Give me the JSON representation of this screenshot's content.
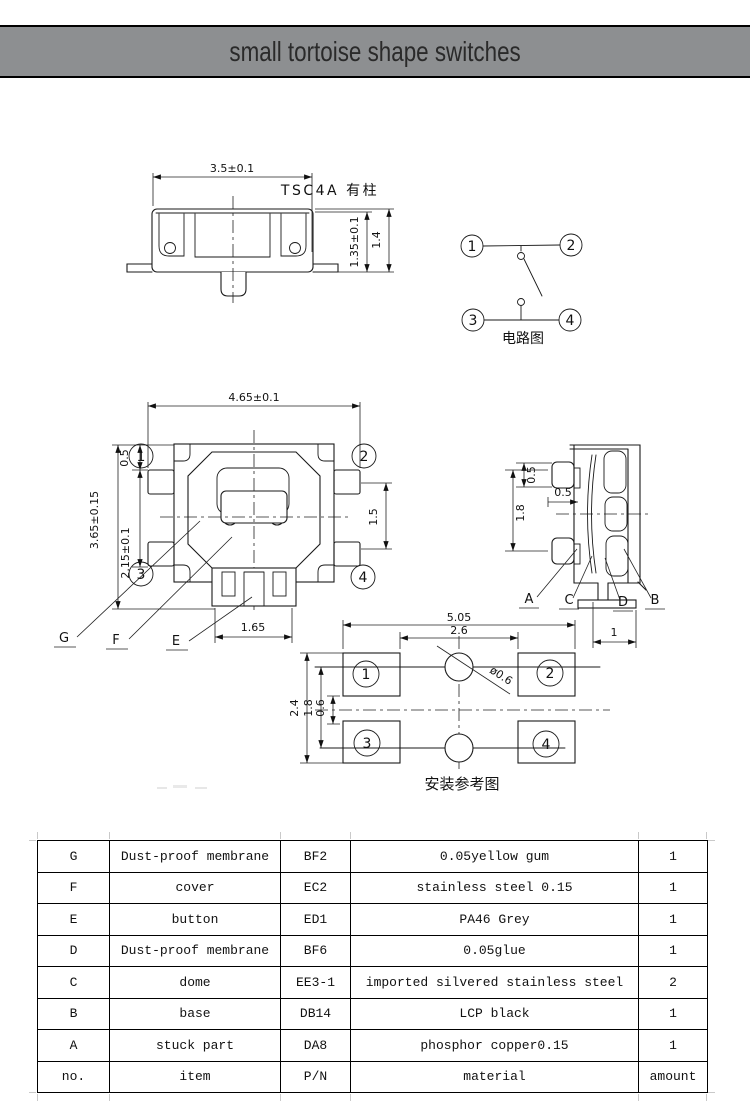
{
  "header": {
    "title": "small tortoise shape switches"
  },
  "side_view": {
    "model_label": "TSC4A 有柱",
    "dim_width": "3.5±0.1",
    "dim_height_inner": "1.35±0.1",
    "dim_height_total": "1.4"
  },
  "circuit": {
    "caption": "电路图",
    "terminals": [
      "1",
      "2",
      "3",
      "4"
    ]
  },
  "top_view": {
    "dim_width": "4.65±0.1",
    "dim_height": "3.65±0.15",
    "dim_offset": "0.5",
    "dim_pitch": "2.15±0.1",
    "dim_button": "1.5",
    "dim_stem": "1.65",
    "terminals": [
      "1",
      "2",
      "3",
      "4"
    ],
    "labels": {
      "g": "G",
      "f": "F",
      "e": "E"
    }
  },
  "right_view": {
    "dim_tab": "0.5",
    "dim_step": "0.5",
    "dim_span": "1.8",
    "dim_foot": "1",
    "labels": {
      "a": "A",
      "c": "C",
      "d": "D",
      "b": "B"
    }
  },
  "mounting": {
    "caption": "安装参考图",
    "dim_outer_width": "5.05",
    "dim_inner_width": "2.6",
    "dim_outer_height": "2.4",
    "dim_hole_pitch": "1.8",
    "dim_gap": "0.6",
    "dim_hole": "ø0.6",
    "terminals": [
      "1",
      "2",
      "3",
      "4"
    ]
  },
  "table": {
    "rows": [
      [
        "G",
        "Dust-proof membrane",
        "BF2",
        "0.05yellow gum",
        "1"
      ],
      [
        "F",
        "cover",
        "EC2",
        "stainless steel 0.15",
        "1"
      ],
      [
        "E",
        "button",
        "ED1",
        "PA46 Grey",
        "1"
      ],
      [
        "D",
        "Dust-proof membrane",
        "BF6",
        "0.05glue",
        "1"
      ],
      [
        "C",
        "dome",
        "EE3-1",
        "imported silvered stainless steel",
        "2"
      ],
      [
        "B",
        "base",
        "DB14",
        "LCP black",
        "1"
      ],
      [
        "A",
        "stuck part",
        "DA8",
        "phosphor copper0.15",
        "1"
      ],
      [
        "no.",
        "item",
        "P/N",
        "material",
        "amount"
      ]
    ]
  },
  "colors": {
    "header_bg": "#8d8f91",
    "rule": "#000000",
    "ink": "#1a1a1a",
    "tick": "#c9c9c9"
  }
}
